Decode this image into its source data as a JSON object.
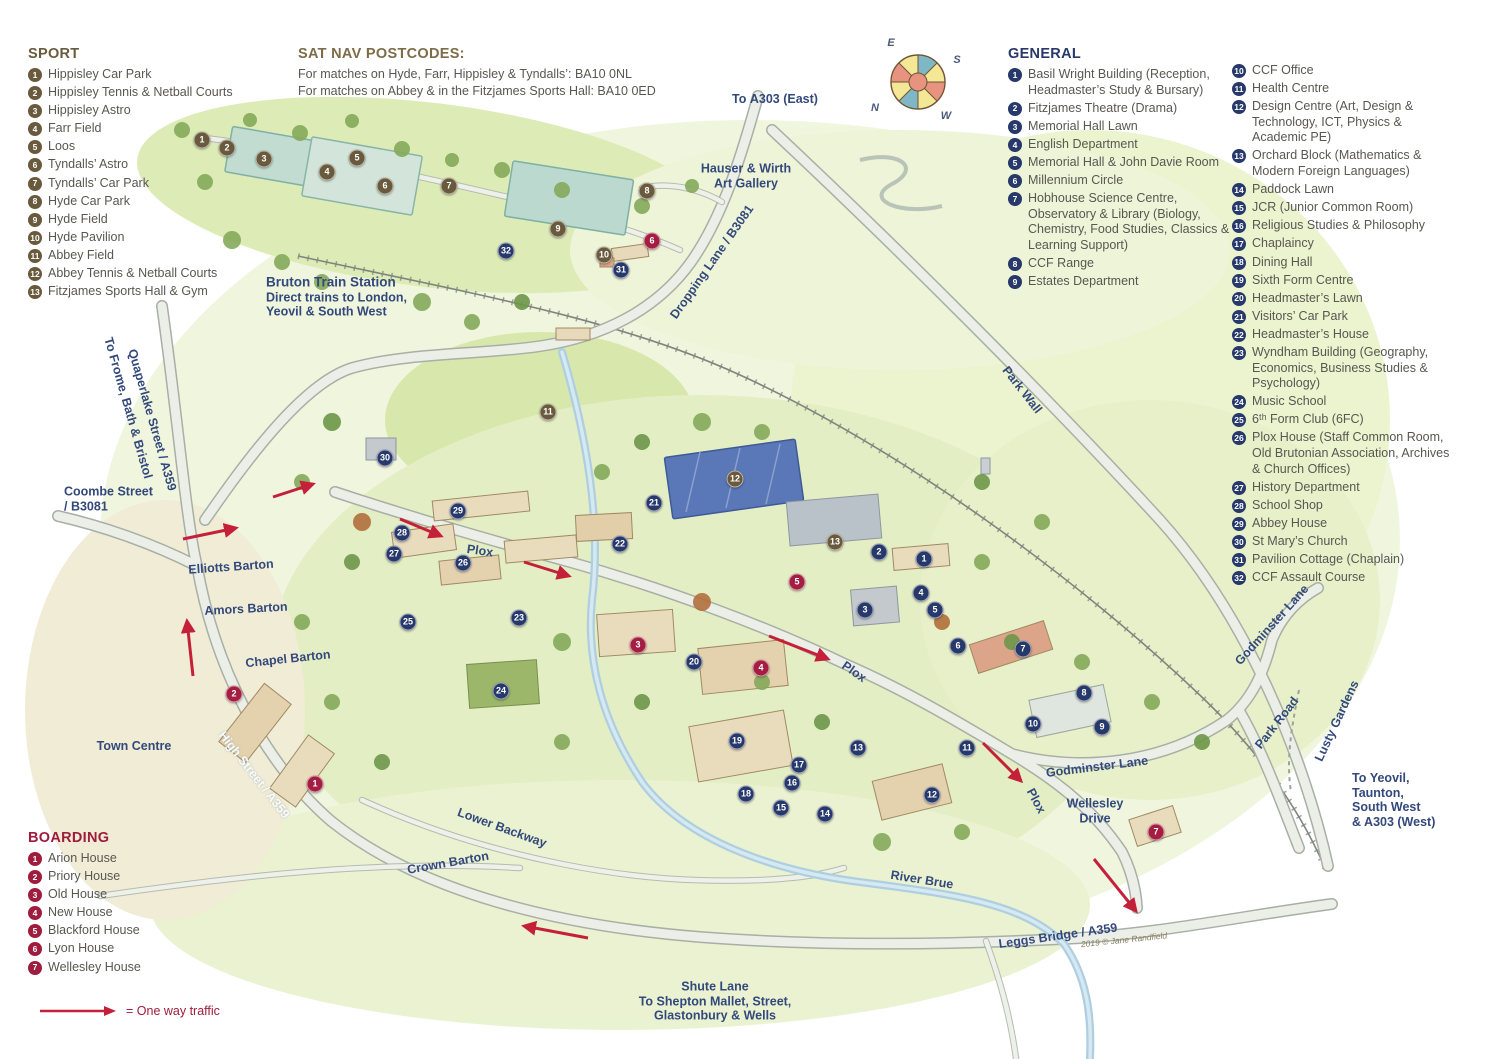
{
  "legends": {
    "sport": {
      "title": "SPORT",
      "color": "#6a5a3d",
      "items": [
        "Hippisley Car Park",
        "Hippisley Tennis & Netball Courts",
        "Hippisley Astro",
        "Farr Field",
        "Loos",
        "Tyndalls’ Astro",
        "Tyndalls’ Car Park",
        "Hyde Car Park",
        "Hyde Field",
        "Hyde Pavilion",
        "Abbey Field",
        "Abbey Tennis & Netball Courts",
        "Fitzjames Sports Hall & Gym"
      ]
    },
    "general": {
      "title": "GENERAL",
      "color": "#27386b",
      "items": [
        "Basil Wright Building (Reception, Headmaster’s Study & Bursary)",
        "Fitzjames Theatre (Drama)",
        "Memorial Hall Lawn",
        "English Department",
        "Memorial Hall & John Davie Room",
        "Millennium Circle",
        "Hobhouse Science Centre, Observatory & Library (Biology, Chemistry, Food Studies, Classics & Learning Support)",
        "CCF Range",
        "Estates Department",
        "CCF Office",
        "Health Centre",
        "Design Centre (Art, Design & Technology, ICT, Physics & Academic PE)",
        "Orchard Block (Mathematics & Modern Foreign Languages)",
        "Paddock Lawn",
        "JCR (Junior Common Room)",
        "Religious Studies & Philosophy",
        "Chaplaincy",
        "Dining Hall",
        "Sixth Form Centre",
        "Headmaster’s Lawn",
        "Visitors’ Car Park",
        "Headmaster’s House",
        "Wyndham Building (Geography, Economics, Business Studies & Psychology)",
        "Music School",
        "6ᵗʰ Form Club (6FC)",
        "Plox House (Staff Common Room, Old Brutonian Association, Archives & Church Offices)",
        "History Department",
        "School Shop",
        "Abbey House",
        "St Mary’s Church",
        "Pavilion Cottage (Chaplain)",
        "CCF Assault Course"
      ],
      "column_split_after": 9
    },
    "boarding": {
      "title": "BOARDING",
      "color": "#9e1c3e",
      "items": [
        "Arion House",
        "Priory House",
        "Old House",
        "New House",
        "Blackford House",
        "Lyon House",
        "Wellesley House"
      ]
    },
    "satnav": {
      "title": "SAT NAV POSTCODES:",
      "lines": [
        "For matches on Hyde, Farr, Hippisley & Tyndalls’: BA10 0NL",
        "For matches on Abbey & in the Fitzjames Sports Hall: BA10 0ED"
      ]
    },
    "oneway_label": "= One way traffic"
  },
  "map": {
    "marker_colors": {
      "s": "#6a5a3d",
      "g": "#27386b",
      "b": "#a41e41"
    },
    "markers": [
      {
        "t": "s",
        "n": 1,
        "x": 202,
        "y": 140
      },
      {
        "t": "s",
        "n": 2,
        "x": 227,
        "y": 148
      },
      {
        "t": "s",
        "n": 3,
        "x": 264,
        "y": 159
      },
      {
        "t": "s",
        "n": 4,
        "x": 327,
        "y": 172
      },
      {
        "t": "s",
        "n": 5,
        "x": 357,
        "y": 158
      },
      {
        "t": "s",
        "n": 6,
        "x": 385,
        "y": 186
      },
      {
        "t": "s",
        "n": 7,
        "x": 449,
        "y": 186
      },
      {
        "t": "s",
        "n": 8,
        "x": 647,
        "y": 191
      },
      {
        "t": "s",
        "n": 9,
        "x": 558,
        "y": 229
      },
      {
        "t": "s",
        "n": 10,
        "x": 604,
        "y": 255
      },
      {
        "t": "s",
        "n": 11,
        "x": 548,
        "y": 412
      },
      {
        "t": "s",
        "n": 12,
        "x": 735,
        "y": 479
      },
      {
        "t": "s",
        "n": 13,
        "x": 835,
        "y": 542
      },
      {
        "t": "g",
        "n": 1,
        "x": 924,
        "y": 559
      },
      {
        "t": "g",
        "n": 2,
        "x": 879,
        "y": 552
      },
      {
        "t": "g",
        "n": 3,
        "x": 865,
        "y": 610
      },
      {
        "t": "g",
        "n": 4,
        "x": 921,
        "y": 593
      },
      {
        "t": "g",
        "n": 5,
        "x": 935,
        "y": 610
      },
      {
        "t": "g",
        "n": 6,
        "x": 958,
        "y": 646
      },
      {
        "t": "g",
        "n": 7,
        "x": 1023,
        "y": 649
      },
      {
        "t": "g",
        "n": 8,
        "x": 1084,
        "y": 693
      },
      {
        "t": "g",
        "n": 9,
        "x": 1102,
        "y": 727
      },
      {
        "t": "g",
        "n": 10,
        "x": 1033,
        "y": 724
      },
      {
        "t": "g",
        "n": 11,
        "x": 967,
        "y": 748
      },
      {
        "t": "g",
        "n": 12,
        "x": 932,
        "y": 795
      },
      {
        "t": "g",
        "n": 13,
        "x": 858,
        "y": 748
      },
      {
        "t": "g",
        "n": 14,
        "x": 825,
        "y": 814
      },
      {
        "t": "g",
        "n": 15,
        "x": 781,
        "y": 808
      },
      {
        "t": "g",
        "n": 16,
        "x": 792,
        "y": 783
      },
      {
        "t": "g",
        "n": 17,
        "x": 799,
        "y": 765
      },
      {
        "t": "g",
        "n": 18,
        "x": 746,
        "y": 794
      },
      {
        "t": "g",
        "n": 19,
        "x": 737,
        "y": 741
      },
      {
        "t": "g",
        "n": 20,
        "x": 694,
        "y": 662
      },
      {
        "t": "g",
        "n": 21,
        "x": 654,
        "y": 503
      },
      {
        "t": "g",
        "n": 22,
        "x": 620,
        "y": 544
      },
      {
        "t": "g",
        "n": 23,
        "x": 519,
        "y": 618
      },
      {
        "t": "g",
        "n": 24,
        "x": 501,
        "y": 691
      },
      {
        "t": "g",
        "n": 25,
        "x": 408,
        "y": 622
      },
      {
        "t": "g",
        "n": 26,
        "x": 463,
        "y": 563
      },
      {
        "t": "g",
        "n": 27,
        "x": 394,
        "y": 554
      },
      {
        "t": "g",
        "n": 28,
        "x": 402,
        "y": 533
      },
      {
        "t": "g",
        "n": 29,
        "x": 458,
        "y": 511
      },
      {
        "t": "g",
        "n": 30,
        "x": 385,
        "y": 458
      },
      {
        "t": "g",
        "n": 31,
        "x": 621,
        "y": 270
      },
      {
        "t": "g",
        "n": 32,
        "x": 506,
        "y": 251
      },
      {
        "t": "b",
        "n": 1,
        "x": 315,
        "y": 784
      },
      {
        "t": "b",
        "n": 2,
        "x": 234,
        "y": 694
      },
      {
        "t": "b",
        "n": 3,
        "x": 638,
        "y": 645
      },
      {
        "t": "b",
        "n": 4,
        "x": 761,
        "y": 668
      },
      {
        "t": "b",
        "n": 5,
        "x": 797,
        "y": 582
      },
      {
        "t": "b",
        "n": 6,
        "x": 652,
        "y": 241
      },
      {
        "t": "b",
        "n": 7,
        "x": 1156,
        "y": 832
      }
    ],
    "labels": [
      {
        "id": "to-a303-east",
        "x": 775,
        "y": 99,
        "lines": [
          {
            "b": "To ",
            "t": "A303 (East)"
          }
        ]
      },
      {
        "id": "hauser-wirth",
        "x": 746,
        "y": 176,
        "lines": [
          {
            "t": "Hauser & Wirth"
          },
          {
            "t": "Art Gallery"
          }
        ]
      },
      {
        "id": "dropping-lane",
        "x": 712,
        "y": 262,
        "rot": -55,
        "lines": [
          {
            "t": "Dropping Lane / B3081"
          }
        ]
      },
      {
        "id": "bruton-train-station",
        "x": 266,
        "y": 297,
        "align": "left",
        "cls": "station",
        "lines": [
          {
            "b": "Bruton Train Station"
          },
          {
            "t": "Direct trains to London,"
          },
          {
            "t": "Yeovil & South West"
          }
        ]
      },
      {
        "id": "quaperlake-street",
        "x": 152,
        "y": 420,
        "rot": 74,
        "lines": [
          {
            "t": "Quaperlake Street / A359"
          }
        ]
      },
      {
        "id": "to-frome-bath-bristol",
        "x": 128,
        "y": 408,
        "rot": 74,
        "lines": [
          {
            "b": "To ",
            "t": "Frome, Bath & Bristol"
          }
        ]
      },
      {
        "id": "coombe-street",
        "x": 64,
        "y": 499,
        "align": "left",
        "lines": [
          {
            "t": "Coombe Street"
          },
          {
            "t": "/ B3081"
          }
        ]
      },
      {
        "id": "elliotts-barton",
        "x": 231,
        "y": 567,
        "rot": -4,
        "lines": [
          {
            "t": "Elliotts Barton"
          }
        ]
      },
      {
        "id": "amors-barton",
        "x": 246,
        "y": 609,
        "rot": -3,
        "lines": [
          {
            "t": "Amors Barton"
          }
        ]
      },
      {
        "id": "chapel-barton",
        "x": 288,
        "y": 659,
        "rot": -6,
        "lines": [
          {
            "t": "Chapel Barton"
          }
        ]
      },
      {
        "id": "town-centre",
        "x": 134,
        "y": 746,
        "lines": [
          {
            "t": "Town Centre"
          }
        ]
      },
      {
        "id": "high-street",
        "x": 254,
        "y": 775,
        "rot": 52,
        "cls": "white",
        "lines": [
          {
            "t": "High Street / A359"
          }
        ]
      },
      {
        "id": "lower-backway",
        "x": 502,
        "y": 828,
        "rot": 20,
        "lines": [
          {
            "t": "Lower Backway"
          }
        ]
      },
      {
        "id": "crown-barton",
        "x": 448,
        "y": 863,
        "rot": -10,
        "lines": [
          {
            "t": "Crown Barton"
          }
        ]
      },
      {
        "id": "river-brue",
        "x": 922,
        "y": 880,
        "rot": 9,
        "lines": [
          {
            "t": "River Brue"
          }
        ]
      },
      {
        "id": "leggs-bridge",
        "x": 1058,
        "y": 936,
        "rot": -8,
        "lines": [
          {
            "t": "Leggs Bridge / A359"
          }
        ]
      },
      {
        "id": "copyright",
        "x": 1124,
        "y": 940,
        "rot": -6,
        "cls": "script",
        "lines": [
          {
            "t": "2019 © Jane Randfield"
          }
        ]
      },
      {
        "id": "shute-lane",
        "x": 715,
        "y": 1001,
        "lines": [
          {
            "t": "Shute Lane"
          },
          {
            "b": "To ",
            "t": "Shepton Mallet, Street,"
          },
          {
            "t": "Glastonbury & Wells"
          }
        ]
      },
      {
        "id": "wellesley-drive",
        "x": 1095,
        "y": 811,
        "lines": [
          {
            "t": "Wellesley"
          },
          {
            "t": "Drive"
          }
        ]
      },
      {
        "id": "godminster-lane",
        "x": 1097,
        "y": 767,
        "rot": -7,
        "lines": [
          {
            "t": "Godminster Lane"
          }
        ]
      },
      {
        "id": "godminster-lane-north",
        "x": 1272,
        "y": 625,
        "rot": -48,
        "lines": [
          {
            "t": "Godminster Lane"
          }
        ]
      },
      {
        "id": "park-road",
        "x": 1277,
        "y": 723,
        "rot": -52,
        "lines": [
          {
            "t": "Park Road"
          }
        ]
      },
      {
        "id": "lusty-gardens",
        "x": 1337,
        "y": 721,
        "rot": -65,
        "lines": [
          {
            "t": "Lusty Gardens"
          }
        ]
      },
      {
        "id": "to-yeovil",
        "x": 1352,
        "y": 800,
        "align": "left",
        "lines": [
          {
            "b": "To ",
            "t": "Yeovil,"
          },
          {
            "t": "Taunton,"
          },
          {
            "t": "South West"
          },
          {
            "t": "& A303 (West)"
          }
        ]
      },
      {
        "id": "park-wall",
        "x": 1022,
        "y": 390,
        "rot": 52,
        "lines": [
          {
            "t": "Park Wall"
          }
        ]
      },
      {
        "id": "plox-west",
        "x": 480,
        "y": 551,
        "rot": 8,
        "lines": [
          {
            "t": "Plox"
          }
        ]
      },
      {
        "id": "plox-east",
        "x": 854,
        "y": 672,
        "rot": 35,
        "lines": [
          {
            "t": "Plox"
          }
        ]
      },
      {
        "id": "plox-south",
        "x": 1036,
        "y": 801,
        "rot": 62,
        "lines": [
          {
            "t": "Plox"
          }
        ]
      }
    ],
    "arrows": [
      [
        183,
        539,
        236,
        528
      ],
      [
        273,
        497,
        313,
        484
      ],
      [
        193,
        676,
        187,
        621
      ],
      [
        400,
        519,
        441,
        536
      ],
      [
        524,
        562,
        569,
        576
      ],
      [
        769,
        636,
        828,
        659
      ],
      [
        983,
        743,
        1021,
        781
      ],
      [
        1094,
        859,
        1136,
        911
      ],
      [
        588,
        938,
        524,
        926
      ]
    ],
    "compass": {
      "e": "E",
      "s": "S",
      "n": "N",
      "w": "W"
    }
  }
}
